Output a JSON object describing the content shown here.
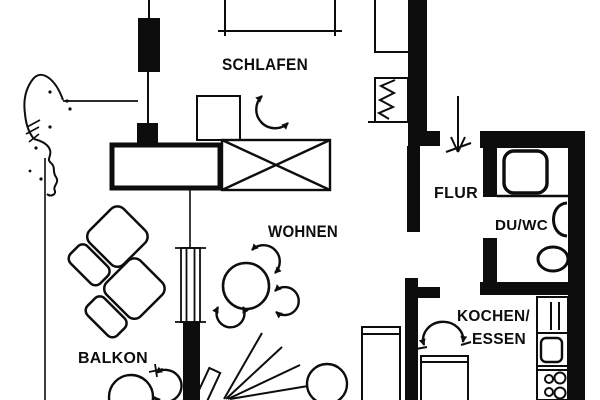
{
  "floorplan": {
    "rooms": {
      "schlafen": "SCHLAFEN",
      "wohnen": "WOHNEN",
      "balkon": "BALKON",
      "flur": "FLUR",
      "du_wc": "DU/WC",
      "kochen_essen_line1": "KOCHEN/",
      "kochen_essen_line2": "ESSEN"
    },
    "colors": {
      "ink": "#0d0d0d",
      "paper": "#ffffff"
    }
  }
}
